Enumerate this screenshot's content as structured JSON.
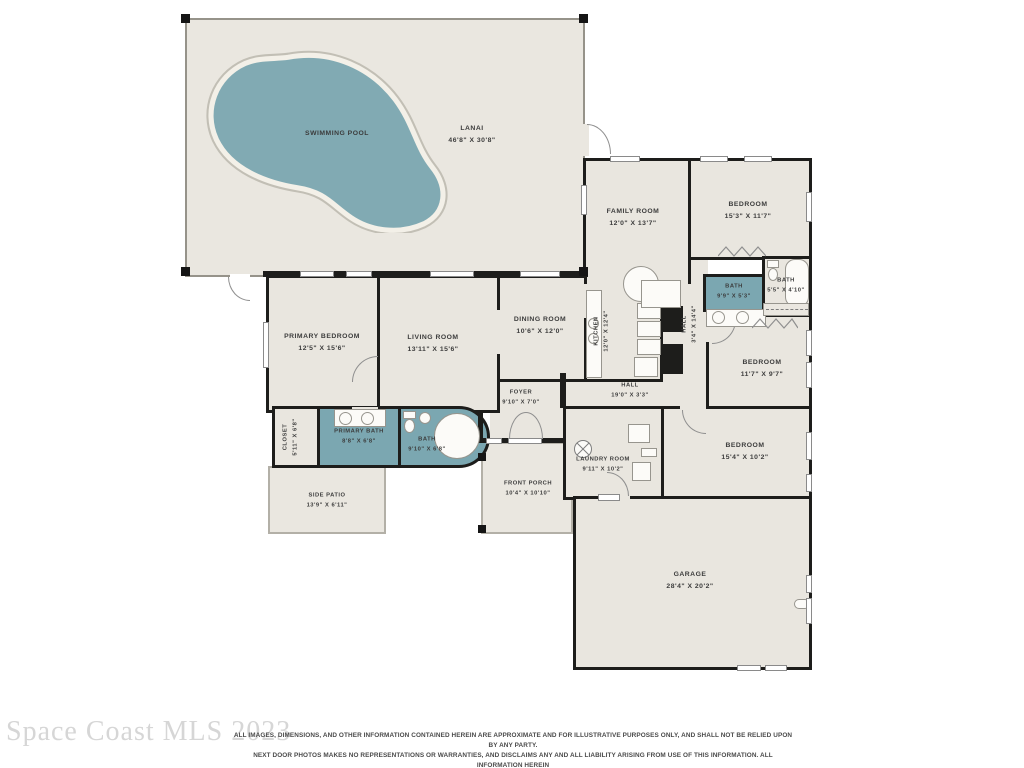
{
  "watermark": "Space Coast MLS 2023",
  "disclaimer": {
    "line1": "ALL IMAGES, DIMENSIONS, AND OTHER INFORMATION CONTAINED HEREIN ARE APPROXIMATE AND FOR ILLUSTRATIVE PURPOSES ONLY, AND SHALL NOT BE RELIED UPON BY ANY PARTY.",
    "line2": "NEXT DOOR PHOTOS MAKES NO REPRESENTATIONS OR WARRANTIES, AND DISCLAIMS ANY AND ALL LIABILITY ARISING FROM USE OF THIS INFORMATION. ALL INFORMATION HEREIN",
    "line3": "SHALL BE SUBJECT TO THE TERMS AND CONDITIONS FOUND AT NEXTDOORPHOTOS.COM/TC."
  },
  "colors": {
    "floor": "#e9e6df",
    "water": "#7ba7b1",
    "wall": "#1d1d1b",
    "patio_outline": "#b3b0a7"
  },
  "rooms": {
    "swimming_pool": {
      "name": "SWIMMING POOL"
    },
    "lanai": {
      "name": "LANAI",
      "dims": "46'8\" X 30'8\""
    },
    "family_room": {
      "name": "FAMILY ROOM",
      "dims": "12'0\" X 13'7\""
    },
    "bedroom_top": {
      "name": "BEDROOM",
      "dims": "15'3\" X 11'7\""
    },
    "bath_hall": {
      "name": "BATH",
      "dims": "9'9\" X 5'3\""
    },
    "bath_small": {
      "name": "BATH",
      "dims": "5'5\" X 4'10\""
    },
    "hall_vert": {
      "name": "HALL",
      "dims": "3'4\" X 14'4\""
    },
    "bedroom_mid": {
      "name": "BEDROOM",
      "dims": "11'7\" X 9'7\""
    },
    "bedroom_low": {
      "name": "BEDROOM",
      "dims": "15'4\" X 10'2\""
    },
    "laundry": {
      "name": "LAUNDRY ROOM",
      "dims": "9'11\" X 10'2\""
    },
    "garage": {
      "name": "GARAGE",
      "dims": "28'4\" X 20'2\""
    },
    "front_porch": {
      "name": "FRONT PORCH",
      "dims": "10'4\" X 10'10\""
    },
    "side_patio": {
      "name": "SIDE PATIO",
      "dims": "13'9\" X 6'11\""
    },
    "closet": {
      "name": "CLOSET",
      "dims": "5'11\" X 6'8\""
    },
    "primary_bath": {
      "name": "PRIMARY BATH",
      "dims": "8'8\" X 6'8\""
    },
    "bath_curved": {
      "name": "BATH",
      "dims": "9'10\" X 6'8\""
    },
    "primary_bedroom": {
      "name": "PRIMARY BEDROOM",
      "dims": "12'5\" X 15'6\""
    },
    "living_room": {
      "name": "LIVING ROOM",
      "dims": "13'11\" X 15'6\""
    },
    "dining_room": {
      "name": "DINING ROOM",
      "dims": "10'6\" X 12'0\""
    },
    "kitchen": {
      "name": "KITCHEN",
      "dims": "12'0\" X 12'4\""
    },
    "hall_horiz": {
      "name": "HALL",
      "dims": "19'0\" X 3'3\""
    },
    "foyer": {
      "name": "FOYER",
      "dims": "9'10\" X 7'0\""
    }
  }
}
